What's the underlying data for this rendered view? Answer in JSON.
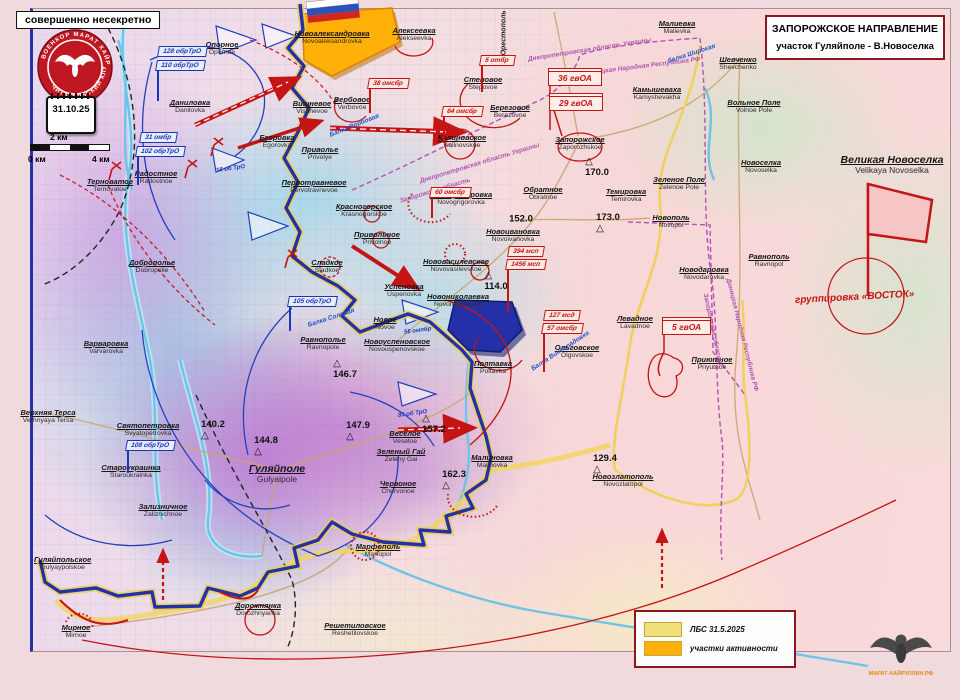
{
  "header": {
    "classification": "совершенно несекретно",
    "title_line1": "ЗАПОРОЖСКОЕ НАПРАВЛЕНИЕ",
    "title_line2": "участок Гуляйполе - В.Новоселка",
    "date": "31.10.25"
  },
  "stamp": {
    "arc_top": "ВОЕНКОР МАРАТ ХАЙРУЛЛИН",
    "arc_bottom": "ЧИТАТЕЛЬСКИЙ КЛУБ"
  },
  "footer_emblem": {
    "caption": "МАРАТ-ХАЙРУЛЛИН.РФ"
  },
  "scalebar": {
    "label0": "0 км",
    "label2": "2 км",
    "label4": "4 км"
  },
  "legend": {
    "items": [
      {
        "swatch": "#f2e07a",
        "label": "ЛБС  31.5.2025"
      },
      {
        "swatch": "#ffb10a",
        "label": "участки активности"
      }
    ]
  },
  "colors": {
    "front_line": "#2430a8",
    "enemy": "#c41414",
    "friendly": "#1b35b8",
    "lbs_old": "#f2d45c",
    "activity": "#ffb10a",
    "boundary": "#b055b0"
  },
  "grouping_label": "группировка «ВОСТОК»",
  "places": [
    {
      "ru": "Новоалександровка",
      "en": "Novoaleksandrovka",
      "x": 332,
      "y": 30
    },
    {
      "ru": "Алексеевка",
      "en": "Alekseevka",
      "x": 414,
      "y": 27
    },
    {
      "ru": "Вербовое",
      "en": "Verbovoe",
      "x": 352,
      "y": 96
    },
    {
      "ru": "Степовое",
      "en": "Stepovoe",
      "x": 483,
      "y": 76
    },
    {
      "ru": "Березовое",
      "en": "Berezovoe",
      "x": 510,
      "y": 104
    },
    {
      "ru": "Калиновское",
      "en": "Kalinovskoe",
      "x": 462,
      "y": 134
    },
    {
      "ru": "Запорожское",
      "en": "Zaporozhskoe",
      "x": 580,
      "y": 136
    },
    {
      "ru": "Обратное",
      "en": "Obratnoe",
      "x": 543,
      "y": 186
    },
    {
      "ru": "Темировка",
      "en": "Temirovka",
      "x": 626,
      "y": 188
    },
    {
      "ru": "Малиевка",
      "en": "Malievka",
      "x": 677,
      "y": 20
    },
    {
      "ru": "Шевченко",
      "en": "Shevchenko",
      "x": 738,
      "y": 56
    },
    {
      "ru": "Вольное Поле",
      "en": "Volnoe Pole",
      "x": 754,
      "y": 99
    },
    {
      "ru": "Камышеваха",
      "en": "Kamyshevakha",
      "x": 657,
      "y": 86
    },
    {
      "ru": "Новоселка",
      "en": "Novoselka",
      "x": 761,
      "y": 159
    },
    {
      "ru": "Великая Новоселка",
      "en": "Velikaya Novoselka",
      "x": 892,
      "y": 155,
      "big": 1
    },
    {
      "ru": "Зеленое Поле",
      "en": "Zelenoe Pole",
      "x": 679,
      "y": 176
    },
    {
      "ru": "Новополь",
      "en": "Novopol",
      "x": 671,
      "y": 214
    },
    {
      "ru": "Равнополь",
      "en": "Ravnopol",
      "x": 769,
      "y": 253
    },
    {
      "ru": "Новодаровка",
      "en": "Novodarovka",
      "x": 704,
      "y": 266
    },
    {
      "ru": "Левадное",
      "en": "Lavadnoe",
      "x": 635,
      "y": 315
    },
    {
      "ru": "Ольговское",
      "en": "Olgovskoe",
      "x": 577,
      "y": 344
    },
    {
      "ru": "Приютное",
      "en": "Priyutnoe",
      "x": 712,
      "y": 356
    },
    {
      "ru": "Новогригоровка",
      "en": "Novogrigorovka",
      "x": 461,
      "y": 191
    },
    {
      "ru": "Новоивановка",
      "en": "Novoivanovka",
      "x": 513,
      "y": 228
    },
    {
      "ru": "Красногорское",
      "en": "Krasnogorskoe",
      "x": 364,
      "y": 203
    },
    {
      "ru": "Привольное",
      "en": "Privolnoe",
      "x": 377,
      "y": 231
    },
    {
      "ru": "Сладкое",
      "en": "Sladkoe",
      "x": 327,
      "y": 259
    },
    {
      "ru": "Успеновка",
      "en": "Uspenovka",
      "x": 404,
      "y": 283
    },
    {
      "ru": "Нововасилевское",
      "en": "Novovasilevskoe",
      "x": 456,
      "y": 258
    },
    {
      "ru": "Новониколаевка",
      "en": "Novonikolaevka",
      "x": 458,
      "y": 293
    },
    {
      "ru": "Новое",
      "en": "Novoe",
      "x": 385,
      "y": 316
    },
    {
      "ru": "Новоуспеновское",
      "en": "Novouspenovskoe",
      "x": 397,
      "y": 338
    },
    {
      "ru": "Полтавка",
      "en": "Poltavka",
      "x": 493,
      "y": 360
    },
    {
      "ru": "Веселое",
      "en": "Veseloe",
      "x": 405,
      "y": 430
    },
    {
      "ru": "Зеленый Гай",
      "en": "Zeleny Gai",
      "x": 401,
      "y": 448
    },
    {
      "ru": "Червоное",
      "en": "Chervonoe",
      "x": 398,
      "y": 480
    },
    {
      "ru": "Малиновка",
      "en": "Malinovka",
      "x": 492,
      "y": 454
    },
    {
      "ru": "Гуляйполе",
      "en": "Gulyaipole",
      "x": 277,
      "y": 464,
      "big": 1
    },
    {
      "ru": "Равнополье",
      "en": "Ravnopole",
      "x": 323,
      "y": 336
    },
    {
      "ru": "Варваровка",
      "en": "Varvarovka",
      "x": 106,
      "y": 340
    },
    {
      "ru": "Доброполье",
      "en": "Dobropolie",
      "x": 152,
      "y": 259
    },
    {
      "ru": "Даниловка",
      "en": "Danilovka",
      "x": 190,
      "y": 99
    },
    {
      "ru": "Опорное",
      "en": "Opornoe",
      "x": 222,
      "y": 41
    },
    {
      "ru": "Вишневое",
      "en": "Vishnevoe",
      "x": 312,
      "y": 100
    },
    {
      "ru": "Егоровка",
      "en": "Egorovka",
      "x": 277,
      "y": 134
    },
    {
      "ru": "Приволье",
      "en": "Privolye",
      "x": 320,
      "y": 146
    },
    {
      "ru": "Первотравневое",
      "en": "Pervotravnevoe",
      "x": 314,
      "y": 179
    },
    {
      "ru": "Радостное",
      "en": "Radostnoe",
      "x": 156,
      "y": 170
    },
    {
      "ru": "Терноватое",
      "en": "Ternovatoe",
      "x": 110,
      "y": 178
    },
    {
      "ru": "Верхняя Терса",
      "en": "Verhnyaya Tersa",
      "x": 48,
      "y": 409
    },
    {
      "ru": "Святопетровка",
      "en": "Svyatopetrovka",
      "x": 148,
      "y": 422
    },
    {
      "ru": "Староукраинка",
      "en": "Staroukrainka",
      "x": 131,
      "y": 464
    },
    {
      "ru": "Зализничное",
      "en": "Zaliznichnoe",
      "x": 163,
      "y": 503
    },
    {
      "ru": "Гуляйпольское",
      "en": "Gulyaypolskoe",
      "x": 34,
      "y": 556,
      "align": "left"
    },
    {
      "ru": "Мирное",
      "en": "Mirnoe",
      "x": 76,
      "y": 624
    },
    {
      "ru": "Дорожнянка",
      "en": "Dorozhnyanka",
      "x": 258,
      "y": 602
    },
    {
      "ru": "Марфополь",
      "en": "Marfopol",
      "x": 378,
      "y": 543
    },
    {
      "ru": "Решетиловское",
      "en": "Reshetilovskoe",
      "x": 355,
      "y": 622
    },
    {
      "ru": "Новозлатополь",
      "en": "Novozlatopol",
      "x": 623,
      "y": 473
    }
  ],
  "elevations": [
    {
      "v": "170.0",
      "x": 597,
      "y": 167,
      "t": "left"
    },
    {
      "v": "152.0",
      "x": 521,
      "y": 219,
      "t": "none"
    },
    {
      "v": "173.0",
      "x": 608,
      "y": 223,
      "t": "right"
    },
    {
      "v": "114.0",
      "x": 496,
      "y": 281,
      "t": "left"
    },
    {
      "v": "146.7",
      "x": 345,
      "y": 369,
      "t": "left"
    },
    {
      "v": "140.2",
      "x": 213,
      "y": 430,
      "t": "right"
    },
    {
      "v": "144.8",
      "x": 266,
      "y": 446,
      "t": "right"
    },
    {
      "v": "147.9",
      "x": 358,
      "y": 431,
      "t": "right"
    },
    {
      "v": "157.2",
      "x": 434,
      "y": 424,
      "t": "left"
    },
    {
      "v": "162.3",
      "x": 454,
      "y": 480,
      "t": "right"
    },
    {
      "v": "129.4",
      "x": 605,
      "y": 464,
      "t": "right"
    }
  ],
  "unit_flags": [
    {
      "label": "5 отбр",
      "x": 480,
      "y": 55,
      "pole": 26
    },
    {
      "label": "38 омсбр",
      "x": 368,
      "y": 78,
      "pole": 24
    },
    {
      "label": "64 омсбр",
      "x": 442,
      "y": 106,
      "pole": 26
    },
    {
      "label": "60 омсбр",
      "x": 430,
      "y": 187,
      "pole": 20
    },
    {
      "label": "394 мсп",
      "x": 508,
      "y": 246,
      "pole": 0
    },
    {
      "label": "1456 мсп",
      "x": 506,
      "y": 259,
      "pole": 42
    },
    {
      "label": "127 мсд",
      "x": 544,
      "y": 310,
      "pole": 0
    },
    {
      "label": "57 омсбр",
      "x": 542,
      "y": 323,
      "pole": 38
    },
    {
      "label": "128 обрТрО",
      "x": 158,
      "y": 46,
      "pole": 0,
      "blue": 1
    },
    {
      "label": "110 обрТрО",
      "x": 156,
      "y": 60,
      "pole": 30,
      "blue": 1
    },
    {
      "label": "31 омбр",
      "x": 140,
      "y": 132,
      "pole": 0,
      "blue": 1
    },
    {
      "label": "102 обрТрО",
      "x": 136,
      "y": 146,
      "pole": 28,
      "blue": 1
    },
    {
      "label": "108 обрТрО",
      "x": 126,
      "y": 440,
      "pole": 22,
      "blue": 1
    },
    {
      "label": "105 обрТрО",
      "x": 288,
      "y": 296,
      "pole": 24,
      "blue": 1
    }
  ],
  "army_boxes": [
    {
      "label": "36 гвОА",
      "x": 548,
      "y": 68
    },
    {
      "label": "29 гвОА",
      "x": 549,
      "y": 93
    },
    {
      "label": "5 гвОА",
      "x": 662,
      "y": 317
    }
  ],
  "small_blue_units": [
    {
      "t": "16 об ТрО",
      "x": 216,
      "y": 166,
      "rot": -8
    },
    {
      "t": "85 об ТрО",
      "x": 398,
      "y": 411,
      "rot": -8
    },
    {
      "t": "56 омпбр",
      "x": 404,
      "y": 328,
      "rot": -8
    }
  ],
  "rot_labels": [
    {
      "t": "Днепропетровская область Украины",
      "x": 420,
      "y": 178,
      "rot": -17,
      "c": "#b055b0",
      "fs": 6.5
    },
    {
      "t": "Запорожская область",
      "x": 400,
      "y": 198,
      "rot": -17,
      "c": "#b055b0",
      "fs": 6.5
    },
    {
      "t": "Днепропетровская область Украины",
      "x": 528,
      "y": 56,
      "rot": -9,
      "c": "#b055b0",
      "fs": 6.5
    },
    {
      "t": "Донецкая Народная Республика РФ",
      "x": 585,
      "y": 70,
      "rot": -7,
      "c": "#b055b0",
      "fs": 6.5
    },
    {
      "t": "Запорожская область",
      "x": 705,
      "y": 290,
      "rot": 78,
      "c": "#b055b0",
      "fs": 6.5
    },
    {
      "t": "Донецкая Народная Республика РФ",
      "x": 728,
      "y": 275,
      "rot": 76,
      "c": "#b055b0",
      "fs": 6.5
    },
    {
      "t": "на Орестополь",
      "x": 504,
      "y": 62,
      "rot": -90,
      "c": "#222222",
      "fs": 7
    },
    {
      "t": "балка Широкая",
      "x": 668,
      "y": 58,
      "rot": -18,
      "c": "#2255cc",
      "fs": 6.5
    },
    {
      "t": "Балка Вербовая",
      "x": 330,
      "y": 132,
      "rot": -22,
      "c": "#2255cc",
      "fs": 6.5
    },
    {
      "t": "Балка Виноградовка",
      "x": 532,
      "y": 366,
      "rot": -33,
      "c": "#2255cc",
      "fs": 6.5
    },
    {
      "t": "Балка Соленая",
      "x": 308,
      "y": 322,
      "rot": -18,
      "c": "#2255cc",
      "fs": 6.5
    }
  ]
}
